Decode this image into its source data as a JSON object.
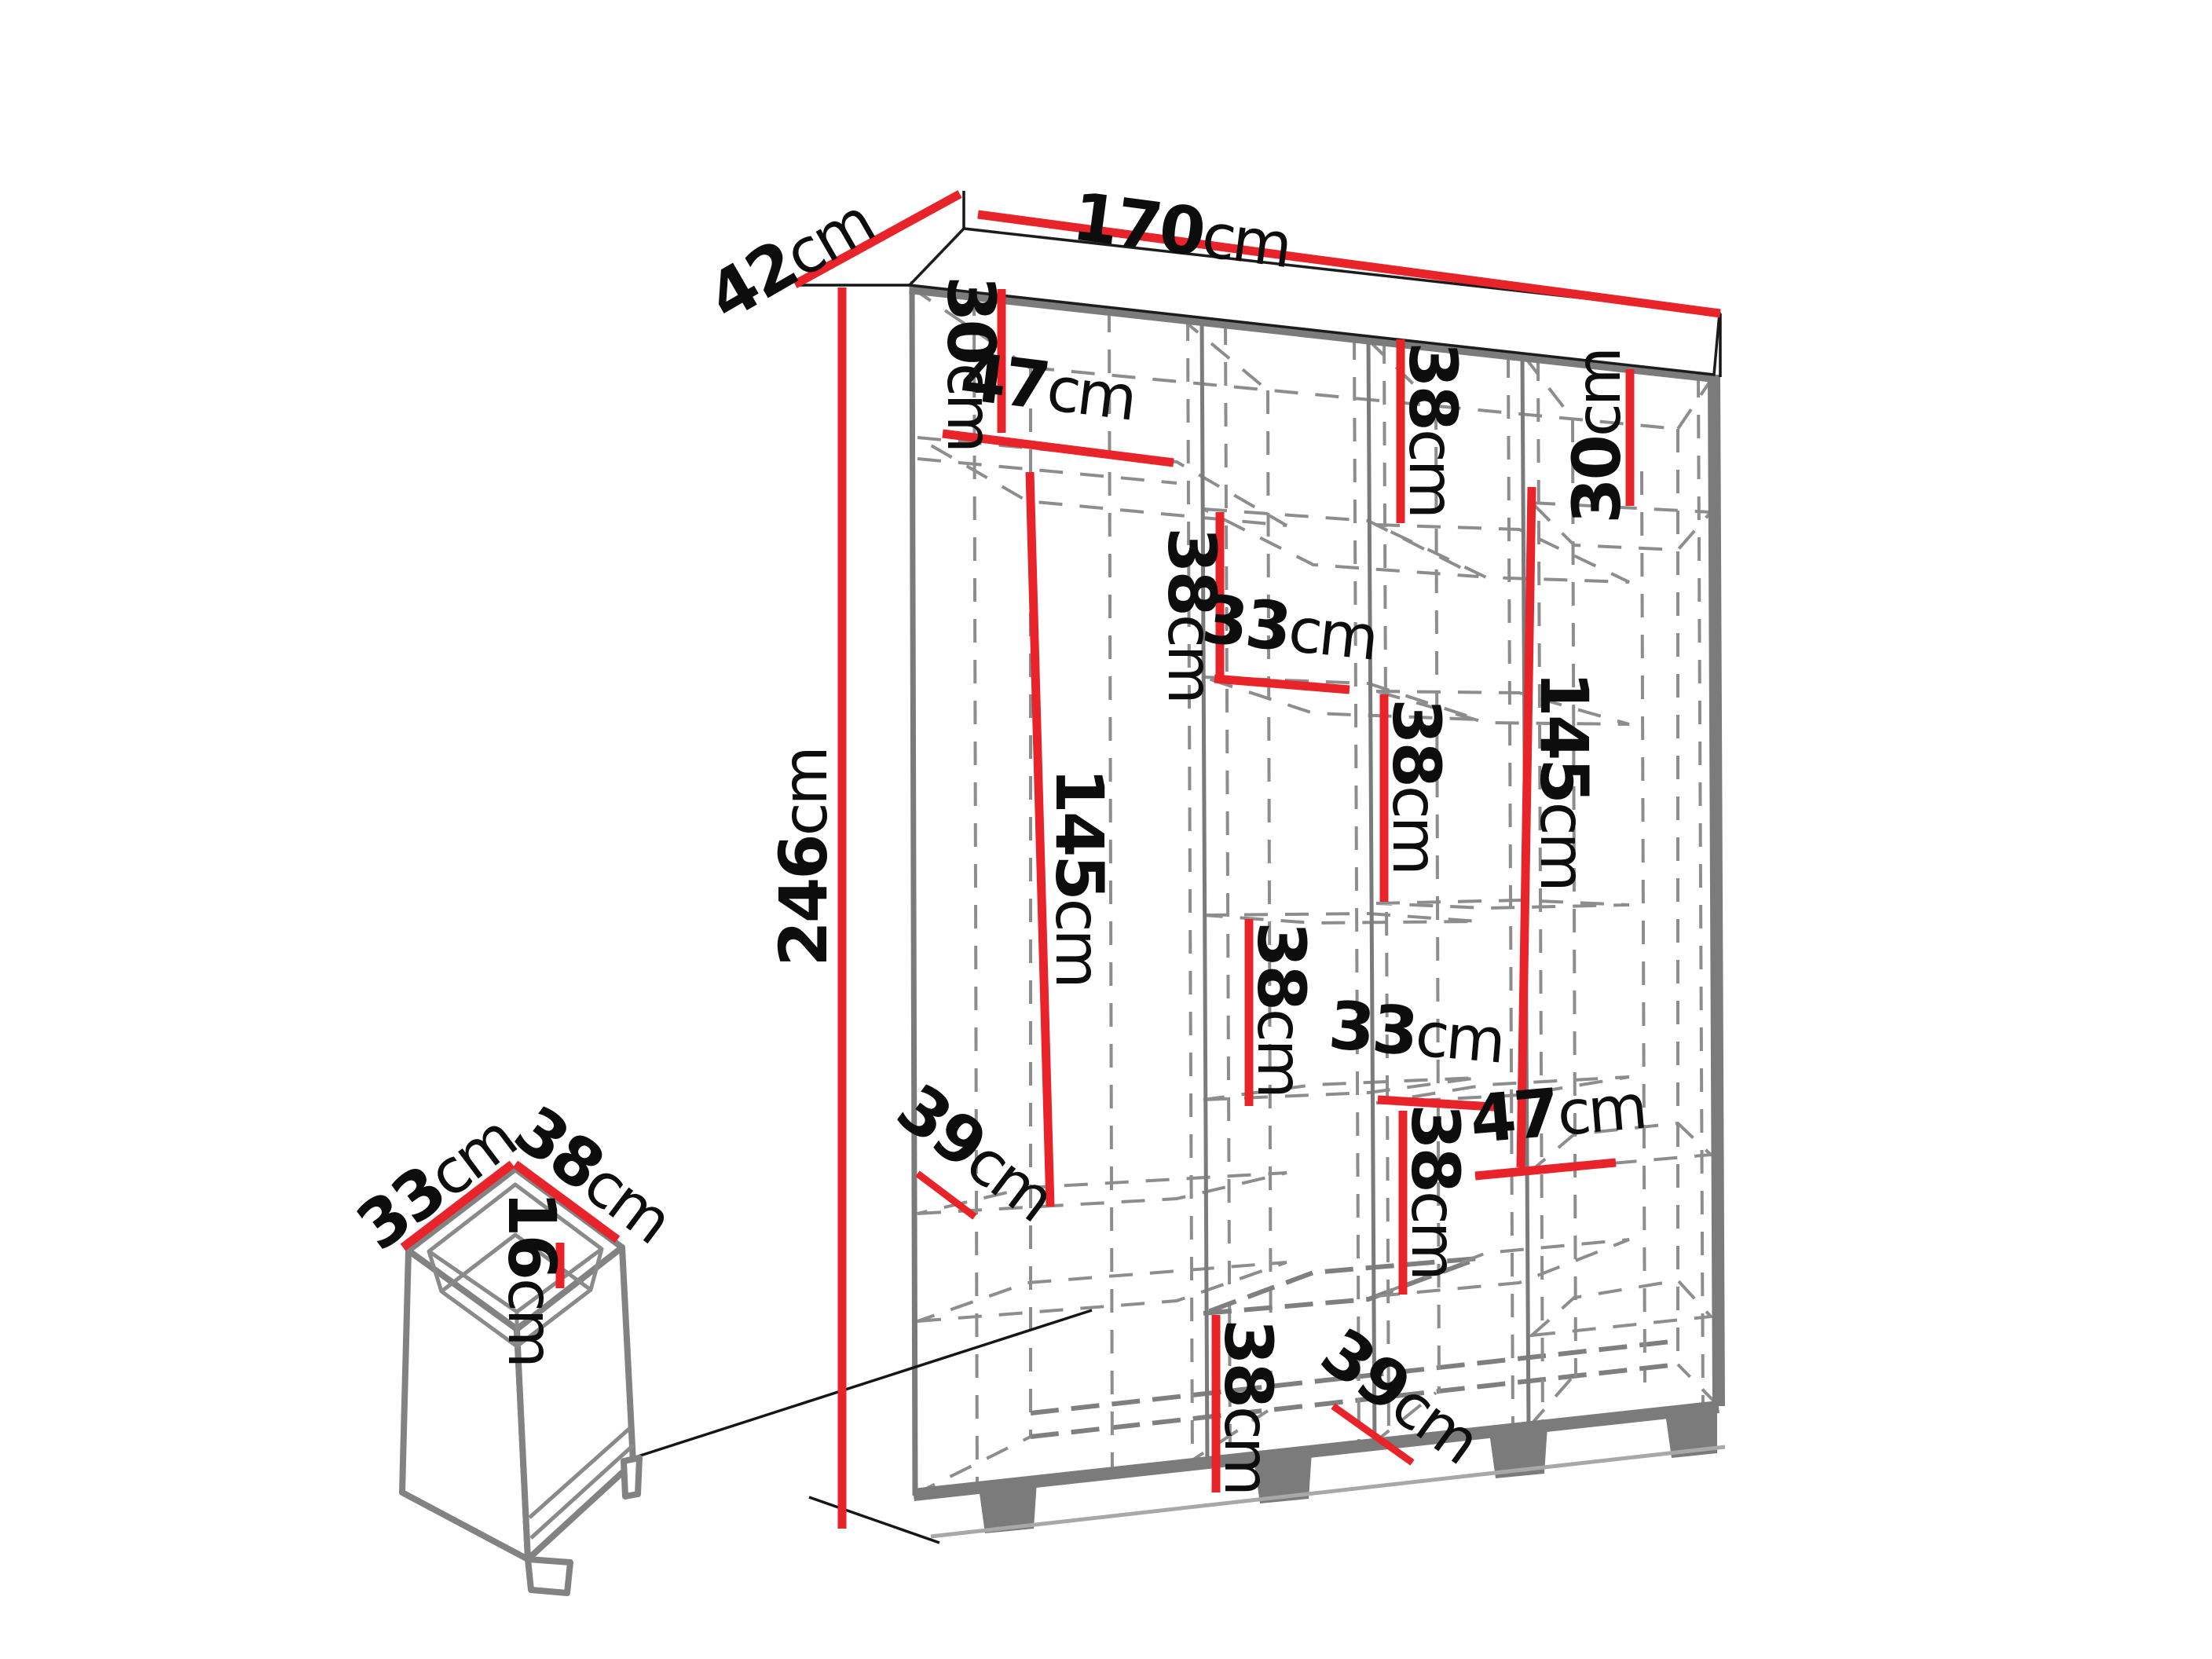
{
  "diagram": {
    "type": "furniture_dimension_diagram",
    "subject": "wardrobe interior dimension drawing with pull-out drawer detail",
    "accent_color": "#e8232a",
    "carcass_color": "#7b7b7b",
    "unit": "cm"
  },
  "dims": {
    "total_width": {
      "value": "170",
      "unit": "cm"
    },
    "total_depth": {
      "value": "42",
      "unit": "cm"
    },
    "total_height": {
      "value": "246",
      "unit": "cm"
    },
    "col1_top_section_height": {
      "value": "30",
      "unit": "cm"
    },
    "col1_shelf_width": {
      "value": "47",
      "unit": "cm"
    },
    "col1_hanging_height": {
      "value": "145",
      "unit": "cm"
    },
    "col1_shelf_depth": {
      "value": "39",
      "unit": "cm"
    },
    "col2_upper_section_height": {
      "value": "38",
      "unit": "cm"
    },
    "col2_shelf_width": {
      "value": "33",
      "unit": "cm"
    },
    "col2_middle_section_height": {
      "value": "38",
      "unit": "cm"
    },
    "col2_bottom_section_height": {
      "value": "38",
      "unit": "cm"
    },
    "col3_top_section_height": {
      "value": "38",
      "unit": "cm"
    },
    "col3_upper_section_height": {
      "value": "38",
      "unit": "cm"
    },
    "col3_shelf_width": {
      "value": "33",
      "unit": "cm"
    },
    "col3_lower_section_height": {
      "value": "38",
      "unit": "cm"
    },
    "col3_shelf_depth": {
      "value": "39",
      "unit": "cm"
    },
    "col4_top_section_height": {
      "value": "30",
      "unit": "cm"
    },
    "col4_hanging_height": {
      "value": "145",
      "unit": "cm"
    },
    "col4_shelf_width": {
      "value": "47",
      "unit": "cm"
    },
    "drawer_width": {
      "value": "33",
      "unit": "cm"
    },
    "drawer_depth": {
      "value": "38",
      "unit": "cm"
    },
    "drawer_height": {
      "value": "16",
      "unit": "cm"
    }
  }
}
